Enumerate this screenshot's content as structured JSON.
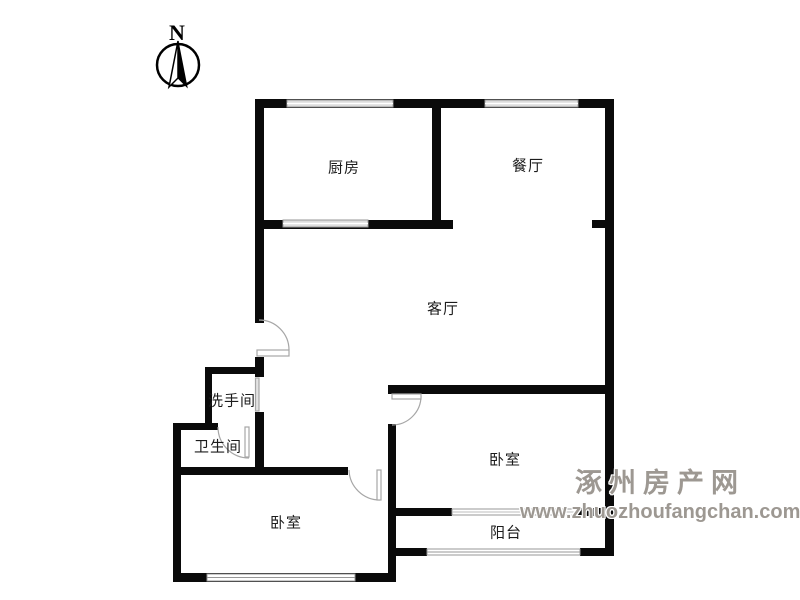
{
  "compass": {
    "label": "N"
  },
  "rooms": {
    "kitchen": {
      "label": "厨房"
    },
    "dining": {
      "label": "餐厅"
    },
    "living": {
      "label": "客厅"
    },
    "washroom": {
      "label": "洗手间"
    },
    "bathroom": {
      "label": "卫生间"
    },
    "bedroom_left": {
      "label": "卧室"
    },
    "bedroom_right": {
      "label": "卧室"
    },
    "balcony": {
      "label": "阳台"
    }
  },
  "watermark": {
    "site_name": "涿州房产网",
    "site_url": "www.zhuozhoufangchan.com"
  },
  "colors": {
    "wall": "#0a0a0a",
    "window_fill": "#dcdcdc",
    "window_line": "#979797",
    "door_line": "#a6a6a6",
    "watermark": "#9d9892"
  }
}
